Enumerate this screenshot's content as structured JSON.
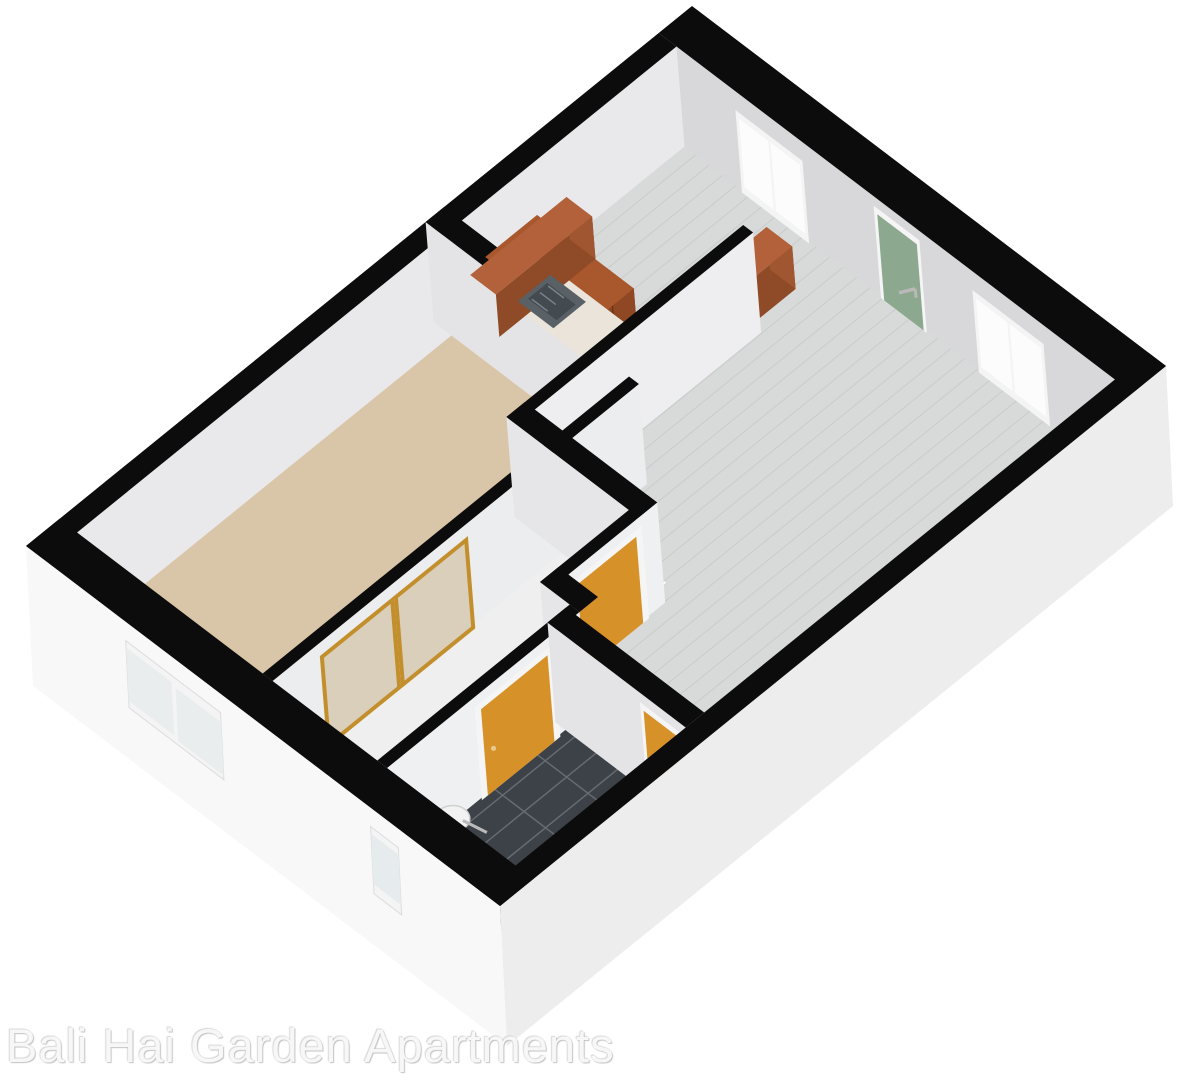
{
  "image": {
    "width": 1195,
    "height": 1080,
    "background": "#ffffff"
  },
  "watermark": {
    "text": "Bali Hai Garden Apartments"
  },
  "palette": {
    "wall_cap": "#0c0c0c",
    "wall_face_north": "#d8d8da",
    "wall_face_west": "#e9e9eb",
    "wall_face_generic": "#e6e6e8",
    "wall_face_light": "#eff0f2",
    "exterior_south": "#f8f8f8",
    "exterior_east": "#ededed",
    "floor_plank": "#d8dad9",
    "floor_plank_grain": "#c9cccb",
    "floor_carpet": "#d9c6a8",
    "floor_hall": "#efefef",
    "floor_tile": "#3d4248",
    "tile_grout": "#676d73",
    "entry_door_green": "#8ca88e",
    "interior_door_orange": "#d79129",
    "door_frame": "#f5f5f5",
    "closet_gold": "#c28f2c",
    "closet_panel": "#dacfbb",
    "cabinet_wood": "#a85a32",
    "cabinet_wood_dark": "#8d4a28",
    "cabinet_wood_top": "#b2613a",
    "counter_marble": "#eae4da",
    "sink_steel": "#596066",
    "sink_steel_dark": "#434a50",
    "window_pane_bright": "#fcfcfd",
    "window_pane_pale": "#e9edee",
    "window_frame": "#f4f4f4",
    "fixture_white": "#f2f2f2",
    "metal": "#b9b9b9"
  },
  "plan": {
    "projection": {
      "origin": [
        692,
        6
      ],
      "ax": [
        39.5,
        30
      ],
      "ay": [
        -74,
        60
      ],
      "drop": [
        10,
        125
      ],
      "floor_drop": [
        9,
        80
      ],
      "skirt": [
        7,
        140
      ],
      "wall_h": 0.8
    },
    "rooms": [
      {
        "name": "kitchen",
        "floor": "plank"
      },
      {
        "name": "living-room",
        "floor": "plank"
      },
      {
        "name": "bedroom",
        "floor": "carpet"
      },
      {
        "name": "hallway",
        "floor": "plain"
      },
      {
        "name": "bathroom",
        "floor": "tile"
      }
    ],
    "floors": [
      {
        "name": "living-kitchen-floor",
        "type": "plank",
        "poly": [
          [
            0.45,
            0.45
          ],
          [
            11.55,
            0.45
          ],
          [
            11.55,
            6.0
          ],
          [
            8.3,
            6.0
          ],
          [
            8.3,
            5.7
          ],
          [
            7.55,
            5.7
          ],
          [
            7.55,
            4.5
          ],
          [
            4.45,
            4.5
          ],
          [
            4.45,
            3.35
          ],
          [
            0.45,
            3.35
          ]
        ]
      },
      {
        "name": "bedroom-carpet",
        "type": "carpet",
        "poly": [
          [
            0.45,
            3.6
          ],
          [
            5.15,
            3.6
          ],
          [
            5.15,
            8.55
          ],
          [
            0.45,
            8.55
          ]
        ]
      },
      {
        "name": "hall-floor",
        "type": "plain",
        "poly": [
          [
            5.4,
            4.75
          ],
          [
            7.55,
            4.75
          ],
          [
            7.55,
            5.95
          ],
          [
            8.05,
            5.95
          ],
          [
            8.05,
            8.55
          ],
          [
            5.4,
            8.55
          ]
        ]
      },
      {
        "name": "bathroom-tile",
        "type": "tile",
        "poly": [
          [
            8.3,
            6.25
          ],
          [
            11.55,
            6.25
          ],
          [
            11.55,
            8.55
          ],
          [
            8.3,
            8.55
          ]
        ]
      }
    ],
    "walls": [
      {
        "name": "north-wall",
        "rect": [
          0,
          0,
          12,
          0.45
        ],
        "face": "s",
        "color": "#d8d8da"
      },
      {
        "name": "west-wall",
        "rect": [
          0,
          0.45,
          0.45,
          9
        ],
        "face": "e",
        "color": "#e9e9eb"
      },
      {
        "name": "bedroom-north-wall",
        "rect": [
          0,
          3.35,
          5.4,
          3.6
        ],
        "face": "s",
        "color": "#e4e4e6"
      },
      {
        "name": "kitchen-living-wall",
        "rect": [
          4.2,
          1.55,
          4.45,
          4.75
        ],
        "face": "e",
        "color": "#eeeef0"
      },
      {
        "name": "bedroom-east-wall",
        "rect": [
          5.15,
          3.6,
          5.4,
          8.55
        ],
        "face": "e",
        "color": "#ecedef"
      },
      {
        "name": "hall-north-wall",
        "rect": [
          4.2,
          4.5,
          7.55,
          4.75
        ],
        "face": "s",
        "color": "#e6e6e8"
      },
      {
        "name": "hall-east-wall",
        "rect": [
          7.3,
          4.5,
          7.55,
          5.95
        ],
        "face": "e",
        "color": "#eff0f2"
      },
      {
        "name": "jog-wall",
        "rect": [
          7.3,
          5.7,
          8.3,
          5.95
        ],
        "face": "s",
        "color": "#e6e6e8"
      },
      {
        "name": "bathroom-west-wall",
        "rect": [
          8.05,
          5.95,
          8.3,
          8.55
        ],
        "face": "e",
        "color": "#eef0f1"
      },
      {
        "name": "bathroom-north-wall",
        "rect": [
          8.05,
          6.0,
          11.55,
          6.25
        ],
        "face": "s",
        "color": "#e4e4e6"
      }
    ],
    "ext_walls": [
      {
        "name": "east-wall",
        "rect": [
          11.55,
          0,
          12,
          9
        ],
        "side": "e",
        "color": "#ededed"
      },
      {
        "name": "south-wall",
        "rect": [
          0,
          8.55,
          12,
          9
        ],
        "side": "s",
        "color": "#f8f8f8"
      }
    ],
    "doors": [
      {
        "name": "entry-door",
        "plane": "y",
        "at": 0.45,
        "from": 5.5,
        "to": 6.5,
        "color": "#8ca88e",
        "handle": true
      },
      {
        "name": "hall-door",
        "plane": "x",
        "at": 7.55,
        "from": 4.8,
        "to": 5.7,
        "color": "#d79129"
      },
      {
        "name": "bathroom-west-door",
        "plane": "x",
        "at": 8.3,
        "from": 6.4,
        "to": 7.3,
        "color": "#d79129"
      },
      {
        "name": "bathroom-north-door",
        "plane": "y",
        "at": 6.25,
        "from": 10.45,
        "to": 11.35,
        "color": "#d79129"
      }
    ],
    "windows_north": [
      {
        "name": "kitchen-window",
        "from": 1.9,
        "to": 3.6
      },
      {
        "name": "living-window",
        "from": 7.9,
        "to": 9.7
      }
    ],
    "windows_south": [
      {
        "name": "bedroom-window",
        "from": 2.5,
        "to": 4.9,
        "panes": 2,
        "pane": "#e9edee"
      },
      {
        "name": "bathroom-window",
        "from": 8.7,
        "to": 9.4,
        "panes": 1,
        "pane": "#e6ebed"
      }
    ],
    "furniture": [
      {
        "name": "kitchen-upper-cabinets",
        "rect": [
          1.0,
          2.65,
          3.45,
          3.35
        ],
        "top_t": 0.16,
        "top": "#a9572d",
        "front": "#8f4724",
        "side": "#7d3e1f",
        "doors": 4
      },
      {
        "name": "kitchen-counter",
        "rect": [
          1.0,
          2.72,
          4.2,
          3.3
        ],
        "top_t": 0.44,
        "top": "#eae4da",
        "front": "#a85a32",
        "side": "#944e2a",
        "doors": 5
      },
      {
        "name": "kitchen-west-counter",
        "rect": [
          0.45,
          2.0,
          1.1,
          3.3
        ],
        "top_t": 0.46,
        "top": "#b2613a",
        "front": "#a05630",
        "side": "#8f4a28",
        "doors": 1
      },
      {
        "name": "kitchen-end-unit",
        "rect": [
          3.55,
          0.95,
          4.2,
          1.6
        ],
        "top_t": 0.46,
        "top": "#b2613a",
        "front": "#a05630",
        "side": "#8f4a28",
        "doors": 1
      }
    ],
    "kitchen_sink": {
      "rect": [
        1.55,
        2.8,
        2.45,
        3.24
      ],
      "t": 0.435
    },
    "closet": {
      "name": "closet-sliding-doors",
      "plane_x": 5.4,
      "panels": [
        [
          5.95,
          6.9
        ],
        [
          6.95,
          7.9
        ]
      ],
      "frame": "#c28f2c",
      "fill": "#dacfbb"
    },
    "pedestal_sink": {
      "name": "bathroom-pedestal-sink",
      "x": 8.9,
      "y": 8.05,
      "t": 0.5
    }
  }
}
